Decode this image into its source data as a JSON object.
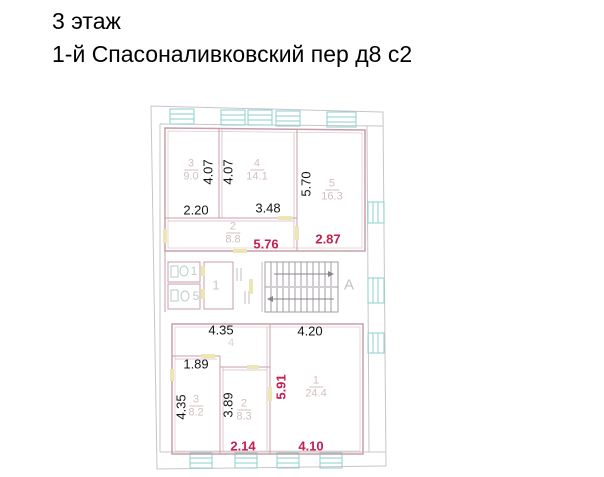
{
  "title": {
    "floor": "3 этаж",
    "address": "1-й Спасоналивковский пер д8 с2"
  },
  "colors": {
    "apartment_walls": "#c79fa8",
    "outer_walls": "#c9c4c9",
    "windows": "#8bd2ce",
    "doors": "#ece5b4",
    "stairs": "#a39da3",
    "room_labels": "#d2bfbf",
    "dimensions_black": "#141414",
    "dimensions_red": "#c41e4f",
    "fixtures": "#b7cdc1"
  },
  "stairwell": {
    "letter": "А"
  },
  "upper_unit": {
    "room3": {
      "number": "3",
      "area": "9.0"
    },
    "room4": {
      "number": "4",
      "area": "14.1"
    },
    "room5": {
      "number": "5",
      "area": "16.3"
    },
    "room2": {
      "number": "2",
      "area": "8.8"
    },
    "dim_room3_width": "2.20",
    "dim_room4_width": "3.48",
    "dim_room3_height": "4.07",
    "dim_room4_height": "4.07",
    "dim_room5_height": "5.70",
    "dim_red_corridor": "5.76",
    "dim_red_room5": "2.87"
  },
  "service_core": {
    "wc_upper": "1",
    "wc_lower": "5",
    "hall": "1"
  },
  "lower_unit": {
    "room1": {
      "number": "1",
      "area": "24.4"
    },
    "room2": {
      "number": "2",
      "area": "8.3"
    },
    "room3": {
      "number": "3",
      "area": "8.2"
    },
    "room4": {
      "number": "4"
    },
    "dim_top_left": "4.35",
    "dim_top_right": "4.20",
    "dim_niche_width": "1.89",
    "dim_room3_height": "4.35",
    "dim_room2_height": "3.89",
    "dim_red_room1_height": "5.91",
    "dim_red_room2_width": "2.14",
    "dim_red_room1_width": "4.10"
  }
}
